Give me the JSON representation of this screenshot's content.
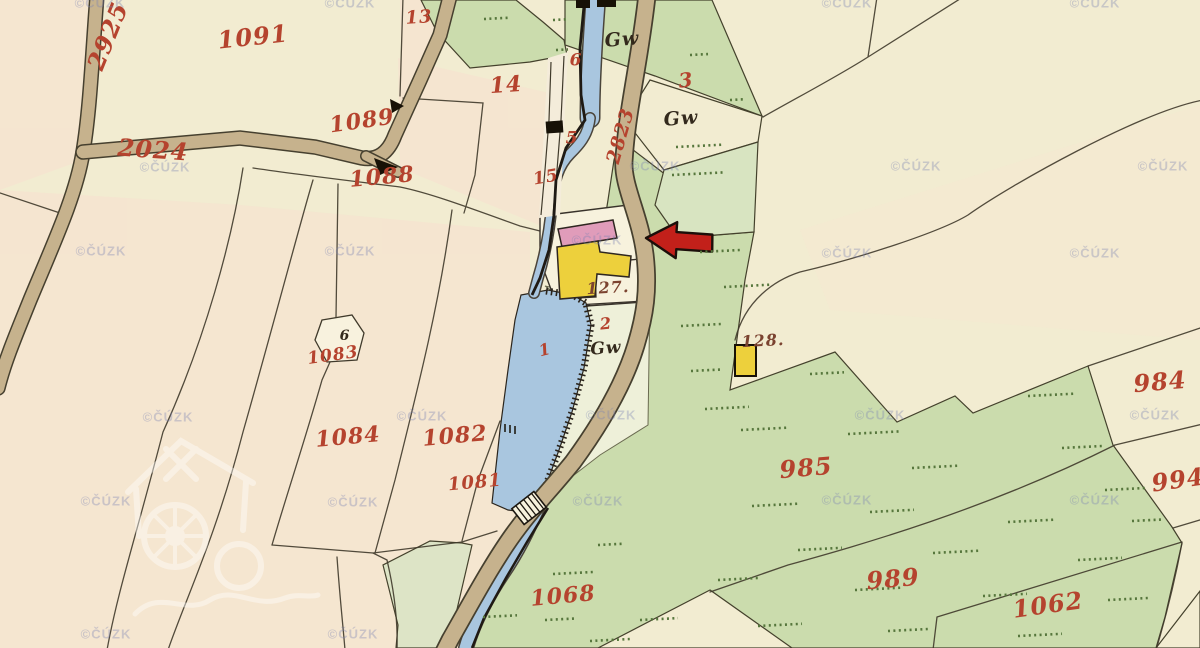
{
  "map": {
    "kind": "historical cadastral map sheet",
    "pointer_arrow": {
      "meaning": "marks property location",
      "direction": "left",
      "fill": "#c2201a",
      "outline": "#1c0f0a",
      "tip_x": 646,
      "tip_y": 238
    },
    "colors": {
      "paper_cream": "#f2ecd1",
      "field_pink_tint": "#f8dfd0",
      "meadow_green": "#cbdcad",
      "meadow_green_light": "#d8e4c1",
      "water_blue": "#a9c6df",
      "road_tan": "#c6b28d",
      "boundary_ink": "#403a2b",
      "building_pink": "#e09cba",
      "building_yellow": "#edd03c",
      "building_black": "#171106",
      "label_red": "#b5432e",
      "label_dark_red": "#7b4330",
      "hatch_green": "#56763c"
    }
  },
  "labels": [
    {
      "text": "2925",
      "x": 108,
      "y": 36,
      "size": 24,
      "rot": -68,
      "color": "red"
    },
    {
      "text": "1091",
      "x": 253,
      "y": 37,
      "size": 24,
      "rot": -6,
      "color": "red"
    },
    {
      "text": "13",
      "x": 419,
      "y": 18,
      "size": 18,
      "rot": -4,
      "color": "red"
    },
    {
      "text": "14",
      "x": 506,
      "y": 85,
      "size": 22,
      "rot": -4,
      "color": "red"
    },
    {
      "text": "1089",
      "x": 362,
      "y": 121,
      "size": 22,
      "rot": -8,
      "color": "red"
    },
    {
      "text": "1088",
      "x": 382,
      "y": 177,
      "size": 22,
      "rot": -5,
      "color": "red"
    },
    {
      "text": "2024",
      "x": 153,
      "y": 150,
      "size": 24,
      "rot": 4,
      "color": "red"
    },
    {
      "text": "15",
      "x": 546,
      "y": 178,
      "size": 17,
      "rot": -10,
      "color": "red"
    },
    {
      "text": "5",
      "x": 572,
      "y": 139,
      "size": 17,
      "rot": 0,
      "color": "red"
    },
    {
      "text": "6",
      "x": 576,
      "y": 61,
      "size": 17,
      "rot": 0,
      "color": "red"
    },
    {
      "text": "3",
      "x": 686,
      "y": 80,
      "size": 20,
      "rot": -6,
      "color": "red"
    },
    {
      "text": "2823",
      "x": 621,
      "y": 136,
      "size": 19,
      "rot": -74,
      "color": "red"
    },
    {
      "text": "127.",
      "x": 608,
      "y": 288,
      "size": 16,
      "rot": -3,
      "color": "darkred"
    },
    {
      "text": "128.",
      "x": 763,
      "y": 341,
      "size": 16,
      "rot": -3,
      "color": "darkred"
    },
    {
      "text": "2",
      "x": 606,
      "y": 324,
      "size": 16,
      "rot": -6,
      "color": "red"
    },
    {
      "text": "1",
      "x": 545,
      "y": 350,
      "size": 16,
      "rot": -14,
      "color": "red"
    },
    {
      "text": "6",
      "x": 345,
      "y": 336,
      "size": 14,
      "rot": 0,
      "color": "black"
    },
    {
      "text": "1083",
      "x": 333,
      "y": 356,
      "size": 17,
      "rot": -8,
      "color": "red"
    },
    {
      "text": "1084",
      "x": 348,
      "y": 437,
      "size": 22,
      "rot": -5,
      "color": "red"
    },
    {
      "text": "1082",
      "x": 455,
      "y": 436,
      "size": 22,
      "rot": -5,
      "color": "red"
    },
    {
      "text": "1081",
      "x": 475,
      "y": 483,
      "size": 18,
      "rot": -5,
      "color": "red"
    },
    {
      "text": "984",
      "x": 1160,
      "y": 382,
      "size": 24,
      "rot": -5,
      "color": "red"
    },
    {
      "text": "994",
      "x": 1178,
      "y": 480,
      "size": 24,
      "rot": -8,
      "color": "red"
    },
    {
      "text": "985",
      "x": 806,
      "y": 468,
      "size": 24,
      "rot": -5,
      "color": "red"
    },
    {
      "text": "989",
      "x": 893,
      "y": 579,
      "size": 24,
      "rot": -5,
      "color": "red"
    },
    {
      "text": "1062",
      "x": 1048,
      "y": 605,
      "size": 24,
      "rot": -8,
      "color": "red"
    },
    {
      "text": "1068",
      "x": 563,
      "y": 596,
      "size": 22,
      "rot": -5,
      "color": "red"
    },
    {
      "text": "Gw",
      "x": 622,
      "y": 40,
      "size": 19,
      "rot": -4,
      "color": "black"
    },
    {
      "text": "Gw",
      "x": 681,
      "y": 119,
      "size": 19,
      "rot": -4,
      "color": "black"
    },
    {
      "text": "Gw",
      "x": 606,
      "y": 349,
      "size": 17,
      "rot": -4,
      "color": "black"
    }
  ],
  "watermarks": {
    "text": "©ČÚZK",
    "positions": [
      [
        100,
        3
      ],
      [
        350,
        3
      ],
      [
        847,
        3
      ],
      [
        1095,
        3
      ],
      [
        165,
        167
      ],
      [
        655,
        166
      ],
      [
        916,
        166
      ],
      [
        1163,
        166
      ],
      [
        597,
        240
      ],
      [
        101,
        251
      ],
      [
        350,
        251
      ],
      [
        847,
        253
      ],
      [
        1095,
        253
      ],
      [
        168,
        417
      ],
      [
        422,
        416
      ],
      [
        611,
        415
      ],
      [
        880,
        415
      ],
      [
        1155,
        415
      ],
      [
        106,
        501
      ],
      [
        353,
        502
      ],
      [
        598,
        501
      ],
      [
        847,
        500
      ],
      [
        1095,
        500
      ],
      [
        106,
        634
      ],
      [
        353,
        634
      ]
    ]
  },
  "hatch_rows": [
    [
      484,
      19,
      26
    ],
    [
      553,
      20,
      14
    ],
    [
      556,
      50,
      12
    ],
    [
      690,
      55,
      18
    ],
    [
      730,
      100,
      16
    ],
    [
      676,
      147,
      46
    ],
    [
      672,
      175,
      52
    ],
    [
      700,
      252,
      42
    ],
    [
      724,
      287,
      46
    ],
    [
      681,
      326,
      40
    ],
    [
      691,
      371,
      32
    ],
    [
      705,
      409,
      44
    ],
    [
      741,
      430,
      46
    ],
    [
      810,
      374,
      34
    ],
    [
      1028,
      396,
      48
    ],
    [
      848,
      434,
      52
    ],
    [
      1062,
      448,
      40
    ],
    [
      912,
      468,
      48
    ],
    [
      1105,
      490,
      40
    ],
    [
      752,
      506,
      48
    ],
    [
      870,
      512,
      44
    ],
    [
      1008,
      522,
      48
    ],
    [
      1132,
      521,
      30
    ],
    [
      798,
      550,
      44
    ],
    [
      933,
      553,
      46
    ],
    [
      1078,
      560,
      44
    ],
    [
      718,
      580,
      40
    ],
    [
      855,
      590,
      48
    ],
    [
      983,
      596,
      44
    ],
    [
      1108,
      600,
      40
    ],
    [
      640,
      620,
      38
    ],
    [
      758,
      626,
      44
    ],
    [
      888,
      631,
      40
    ],
    [
      1018,
      636,
      44
    ],
    [
      553,
      574,
      40
    ],
    [
      598,
      545,
      24
    ],
    [
      545,
      620,
      30
    ],
    [
      483,
      617,
      34
    ],
    [
      590,
      641,
      40
    ]
  ]
}
